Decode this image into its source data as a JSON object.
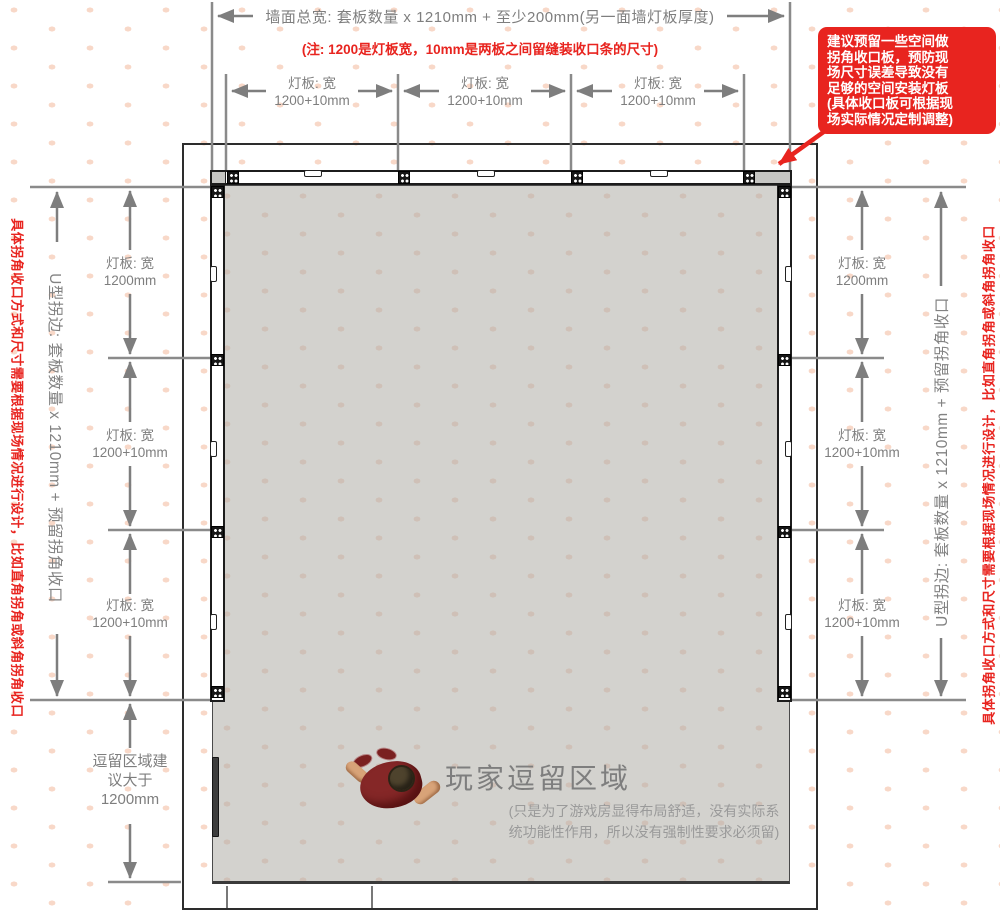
{
  "colors": {
    "accent_red": "#e8241f",
    "dim_text": "#7e7e7e",
    "floor": "#d3d2ce"
  },
  "top_dimension": {
    "total_label": "墙面总宽: 套板数量 x 1210mm + 至少200mm(另一面墙灯板厚度)",
    "note": "(注: 1200是灯板宽，10mm是两板之间留缝装收口条的尺寸)",
    "panels": [
      {
        "label": "灯板: 宽\n1200+10mm"
      },
      {
        "label": "灯板: 宽\n1200+10mm"
      },
      {
        "label": "灯板: 宽\n1200+10mm"
      }
    ]
  },
  "callout": {
    "text": "建议预留一些空间做\n拐角收口板，预防现\n场尺寸误差导致没有\n足够的空间安装灯板\n(具体收口板可根据现\n场实际情况定制调整)"
  },
  "left_dimension": {
    "red_note": "具体拐角收口方式和尺寸需要根据现场情况进行设计，比如直角拐角或斜角拐角收口",
    "u_edge_label": "U型拐边: 套板数量 x 1210mm + 预留拐角收口",
    "panels": [
      {
        "label": "灯板: 宽\n1200mm"
      },
      {
        "label": "灯板: 宽\n1200+10mm"
      },
      {
        "label": "灯板: 宽\n1200+10mm"
      }
    ],
    "stay_area_label": "逗留区域建\n议大于\n1200mm"
  },
  "right_dimension": {
    "red_note": "具体拐角收口方式和尺寸需要根据现场情况进行设计，比如直角拐角或斜角拐角收口",
    "u_edge_label": "U型拐边: 套板数量 x 1210mm + 预留拐角收口",
    "panels": [
      {
        "label": "灯板: 宽\n1200mm"
      },
      {
        "label": "灯板: 宽\n1200+10mm"
      },
      {
        "label": "灯板: 宽\n1200+10mm"
      }
    ]
  },
  "room": {
    "player_area_title": "玩家逗留区域",
    "player_area_note": "(只是为了游戏房显得布局舒适，没有实际系\n统功能性作用，所以没有强制性要求必须留)"
  }
}
